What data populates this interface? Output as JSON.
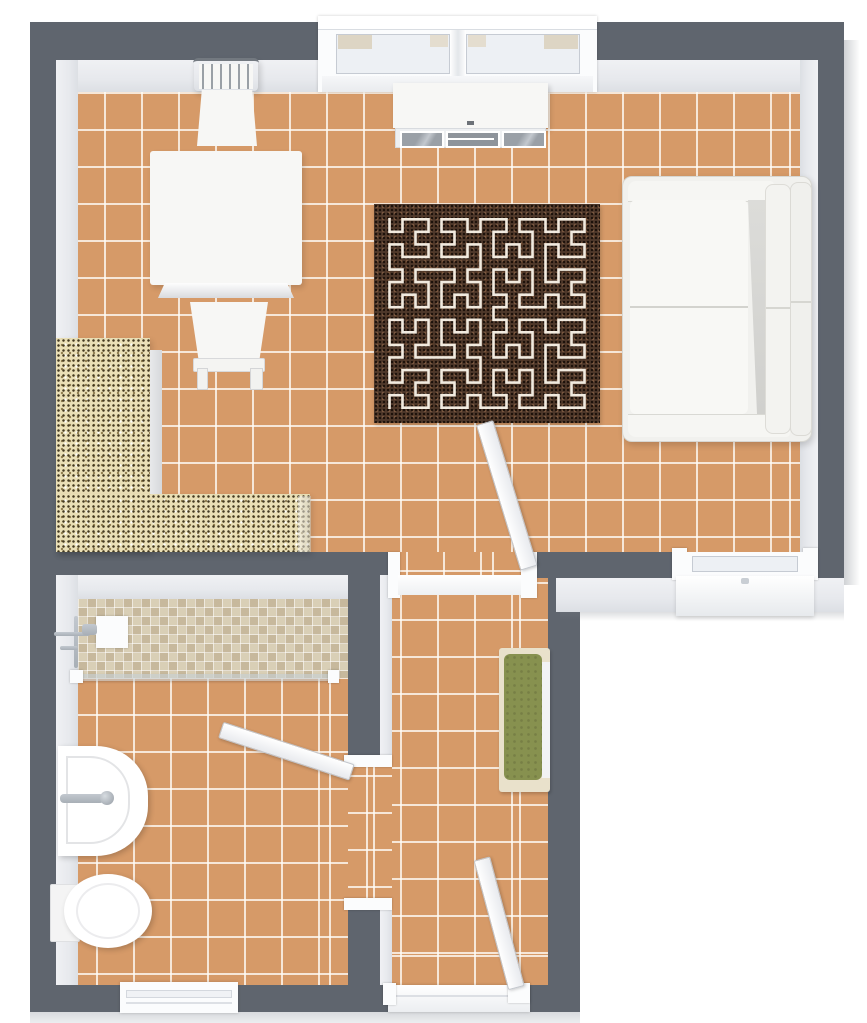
{
  "scene": {
    "type": "3d-floor-plan-top-view",
    "description": "small apartment floor plan: living room with open kitchen, bathroom, hallway",
    "rooms": [
      {
        "name": "living-room-kitchen",
        "floor": "terracotta-tile",
        "furniture": [
          "kitchen-counter-l-shaped",
          "dining-table",
          "dining-chair-top",
          "dining-chair-bottom",
          "sideboard",
          "area-rug",
          "sofa"
        ],
        "openings": [
          "double-window-top-wall",
          "window-bottom-right-wall",
          "open-door-to-hallway"
        ]
      },
      {
        "name": "bathroom",
        "floor": "terracotta-tile",
        "features": [
          "mosaic-shower-area",
          "shower-glass-partition",
          "shower-fixture",
          "washbasin",
          "toilet"
        ],
        "openings": [
          "open-door-to-hallway",
          "window-bottom-wall"
        ]
      },
      {
        "name": "hallway",
        "floor": "terracotta-tile",
        "furniture": [
          "bench-with-green-cushion"
        ],
        "openings": [
          "doorway-to-living-room",
          "entry-door-open"
        ]
      }
    ],
    "tile_size_px": 37
  },
  "palette": {
    "wall": "#5f656e",
    "wall-face": "#e7e9ed",
    "outside": "#ffffff",
    "tile": "#d69a68",
    "grout": "rgba(255,252,247,0.78)",
    "counter": "#eadfb6",
    "mosaic": "#d9cfb6",
    "rug-base": "#4e382a",
    "rug-line": "#f1eadf",
    "bench-cushion": "#87914f",
    "bench-frame": "#e9e1cb",
    "furniture-white": "#f7f7f5",
    "sofa": "#f1f1ee",
    "chrome": "#a8afb6",
    "pane": "#edf0f4"
  },
  "decor": {
    "rug_pattern": {
      "type": "hilbert-curve",
      "order": 4,
      "stroke_width": 2.6
    }
  }
}
